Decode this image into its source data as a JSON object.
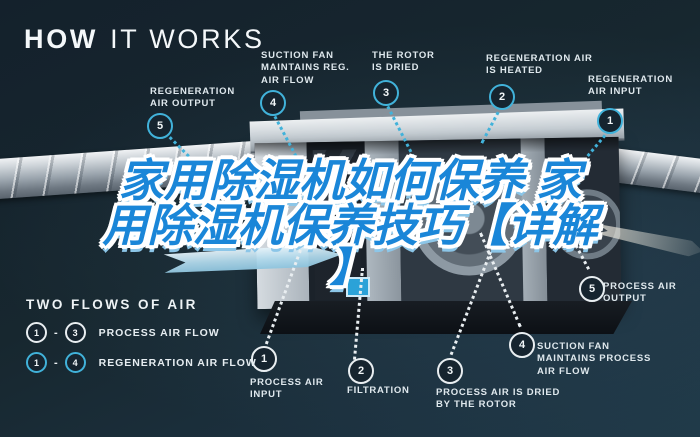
{
  "title": {
    "strong": "HOW",
    "rest": "IT WORKS"
  },
  "overlay": {
    "line1": "家用除湿机如何保养 家",
    "line2": "用除湿机保养技巧【详解",
    "line3": "】",
    "color": "#1a86d8"
  },
  "regeneration_flow": {
    "name": "REGENERATION AIR FLOW",
    "accent_color": "#41b2da",
    "steps": [
      {
        "num": "1",
        "label": "REGENERATION AIR INPUT"
      },
      {
        "num": "2",
        "label": "REGENERATION AIR IS HEATED"
      },
      {
        "num": "3",
        "label": "THE ROTOR IS DRIED"
      },
      {
        "num": "4",
        "label": "SUCTION FAN MAINTAINS REG. AIR FLOW"
      },
      {
        "num": "5",
        "label": "REGENERATION AIR OUTPUT"
      }
    ]
  },
  "process_flow": {
    "name": "PROCESS AIR FLOW",
    "accent_color": "#e9eef1",
    "steps": [
      {
        "num": "1",
        "label": "PROCESS AIR INPUT"
      },
      {
        "num": "2",
        "label": "FILTRATION"
      },
      {
        "num": "3",
        "label": "PROCESS AIR IS DRIED BY THE ROTOR"
      },
      {
        "num": "4",
        "label": "SUCTION FAN MAINTAINS PROCESS AIR FLOW"
      },
      {
        "num": "5",
        "label": "PROCESS AIR OUTPUT"
      }
    ]
  },
  "legend": {
    "title": "TWO FLOWS OF AIR",
    "rows": [
      {
        "from": "1",
        "dash": "-",
        "to": "3",
        "label": "PROCESS AIR FLOW"
      },
      {
        "from": "1",
        "dash": "-",
        "to": "4",
        "label": "REGENERATION AIR FLOW"
      }
    ]
  },
  "colors": {
    "background": "#16242f",
    "accent_cyan": "#41b2da",
    "ring_white": "#e9eef1",
    "overlay_blue": "#1a86d8",
    "label_text": "#dfe8ed"
  }
}
